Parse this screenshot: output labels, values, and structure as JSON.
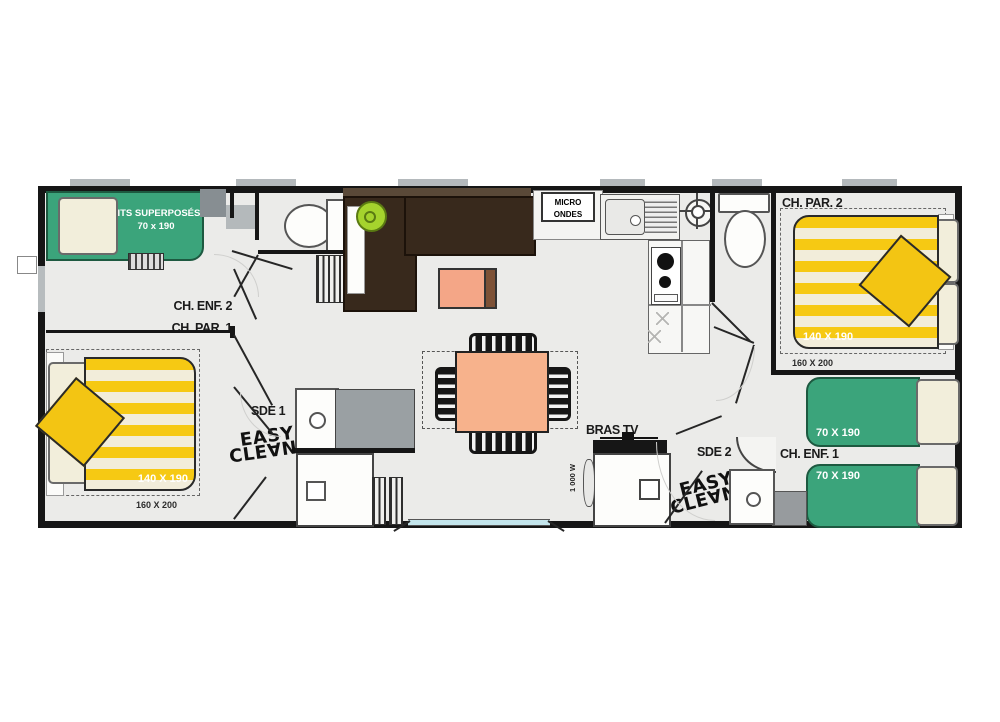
{
  "plan": {
    "rooms": {
      "ch_enf_2": "CH. ENF. 2",
      "ch_par_1": "CH. PAR. 1",
      "ch_par_2": "CH. PAR. 2",
      "ch_enf_1": "CH. ENF. 1",
      "sde_1": "SDE 1",
      "sde_2": "SDE 2"
    },
    "furniture": {
      "bunk_bed_line1": "LITS SUPERPOSÉS",
      "bunk_bed_line2": "70 x 190",
      "bed_par1_size": "140 X 190",
      "bed_par1_alt": "160 X 200",
      "bed_par2_size": "140 X 190",
      "bed_par2_alt": "160 X 200",
      "bed_enf1_top_size": "70 X 190",
      "bed_enf1_bottom_size": "70 X 190",
      "microwave_line1": "MICRO",
      "microwave_line2": "ONDES",
      "tv_bracket": "BRAS TV",
      "heater_power": "1 000 W"
    },
    "branding": {
      "easy_clean_top": "EASY",
      "easy_clean_bottom": "CLE∀N"
    },
    "colors": {
      "bed_green": "#3ba47b",
      "bed_yellow": "#f5c515",
      "table_salmon": "#f7b28c",
      "sofa_brown": "#38291c",
      "cushion_lime": "#a5d32d",
      "wall_black": "#161616",
      "bay_window_blue": "#c3e5ec"
    }
  }
}
